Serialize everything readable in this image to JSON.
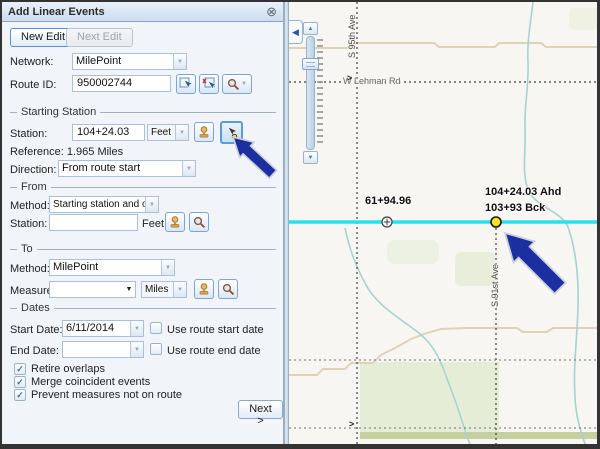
{
  "glyphs": {
    "close": "⊗",
    "dropdown": "▼",
    "check": "✓",
    "collapse": "◀",
    "slider_up": "▲",
    "slider_down": "▼",
    "road_arrow": ">"
  },
  "panel": {
    "title": "Add Linear Events",
    "buttons": {
      "new_edit": "New Edit",
      "next_edit": "Next Edit"
    },
    "network": {
      "label": "Network:",
      "value": "MilePoint"
    },
    "route_id": {
      "label": "Route ID:",
      "value": "950002744"
    },
    "starting_station": {
      "section_label": "Starting Station",
      "station_label": "Station:",
      "station_value": "104+24.03",
      "station_unit": "Feet",
      "reference": "Reference: 1.965 Miles",
      "direction_label": "Direction:",
      "direction_value": "From route start"
    },
    "from": {
      "section_label": "From",
      "method_label": "Method:",
      "method_value": "Starting station and offset",
      "station_label": "Station:",
      "station_value": "",
      "station_unit": "Feet"
    },
    "to": {
      "section_label": "To",
      "method_label": "Method:",
      "method_value": "MilePoint",
      "measure_label": "Measure:",
      "measure_value": "",
      "measure_unit": "Miles"
    },
    "dates": {
      "section_label": "Dates",
      "start_label": "Start Date:",
      "start_value": "6/11/2014",
      "start_checkbox": "Use route start date",
      "end_label": "End Date:",
      "end_value": "",
      "end_checkbox": "Use route end date"
    },
    "options": [
      {
        "label": "Retire overlaps",
        "checked": true
      },
      {
        "label": "Merge coincident events",
        "checked": true
      },
      {
        "label": "Prevent measures not on route",
        "checked": true
      }
    ],
    "next_button": "Next >"
  },
  "map": {
    "labels": {
      "station_left": "61+94.96",
      "station_ahead": "104+24.03 Ahd",
      "station_back": "103+93 Bck",
      "road_vertical_top": "S 95th Ave",
      "road_horizontal": "W Lehman Rd",
      "road_vertical_right": "S 91st Ave"
    },
    "colors": {
      "route": "#29e1ed",
      "marker_fill": "#ffe226",
      "callout_arrow": "#1c2fa0",
      "stream": "#a5d3cf",
      "road_tan": "#ddd3b6",
      "vegetation": "#e8eeda"
    }
  }
}
